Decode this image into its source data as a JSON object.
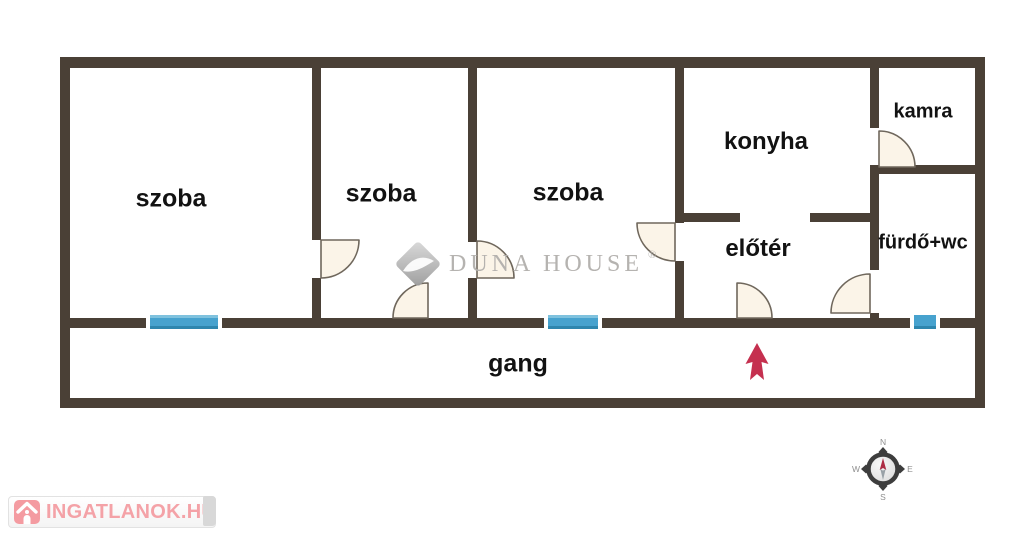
{
  "page": {
    "type": "real-estate floor plan",
    "background": "#ffffff"
  },
  "colors": {
    "wall": "#4a4036",
    "window_blue": "#47a2ce",
    "door_fill": "#fbf4e8",
    "door_stroke": "#6f675c",
    "entrance_arrow_red": "#c5304f",
    "watermark_gray": "#b2afac",
    "logo_pink": "#f49ba1",
    "compass_ring": "#3d3d3d",
    "label_black": "#121212"
  },
  "floor_plan": {
    "rooms": [
      {
        "id": "szoba-1",
        "label": "szoba"
      },
      {
        "id": "szoba-2",
        "label": "szoba"
      },
      {
        "id": "szoba-3",
        "label": "szoba"
      },
      {
        "id": "konyha",
        "label": "konyha"
      },
      {
        "id": "kamra",
        "label": "kamra"
      },
      {
        "id": "elater",
        "label": "előtér"
      },
      {
        "id": "furdo-wc",
        "label": "fürdő+wc"
      },
      {
        "id": "gang",
        "label": "gang"
      }
    ],
    "windows_count": 3,
    "doors_count": 7
  },
  "watermark": {
    "brand": "DUNA HOUSE",
    "registered": "®"
  },
  "compass": {
    "north": "N",
    "east": "E",
    "south": "S",
    "west": "W"
  },
  "footer_logo": {
    "text": "INGATLANOK.HU"
  }
}
